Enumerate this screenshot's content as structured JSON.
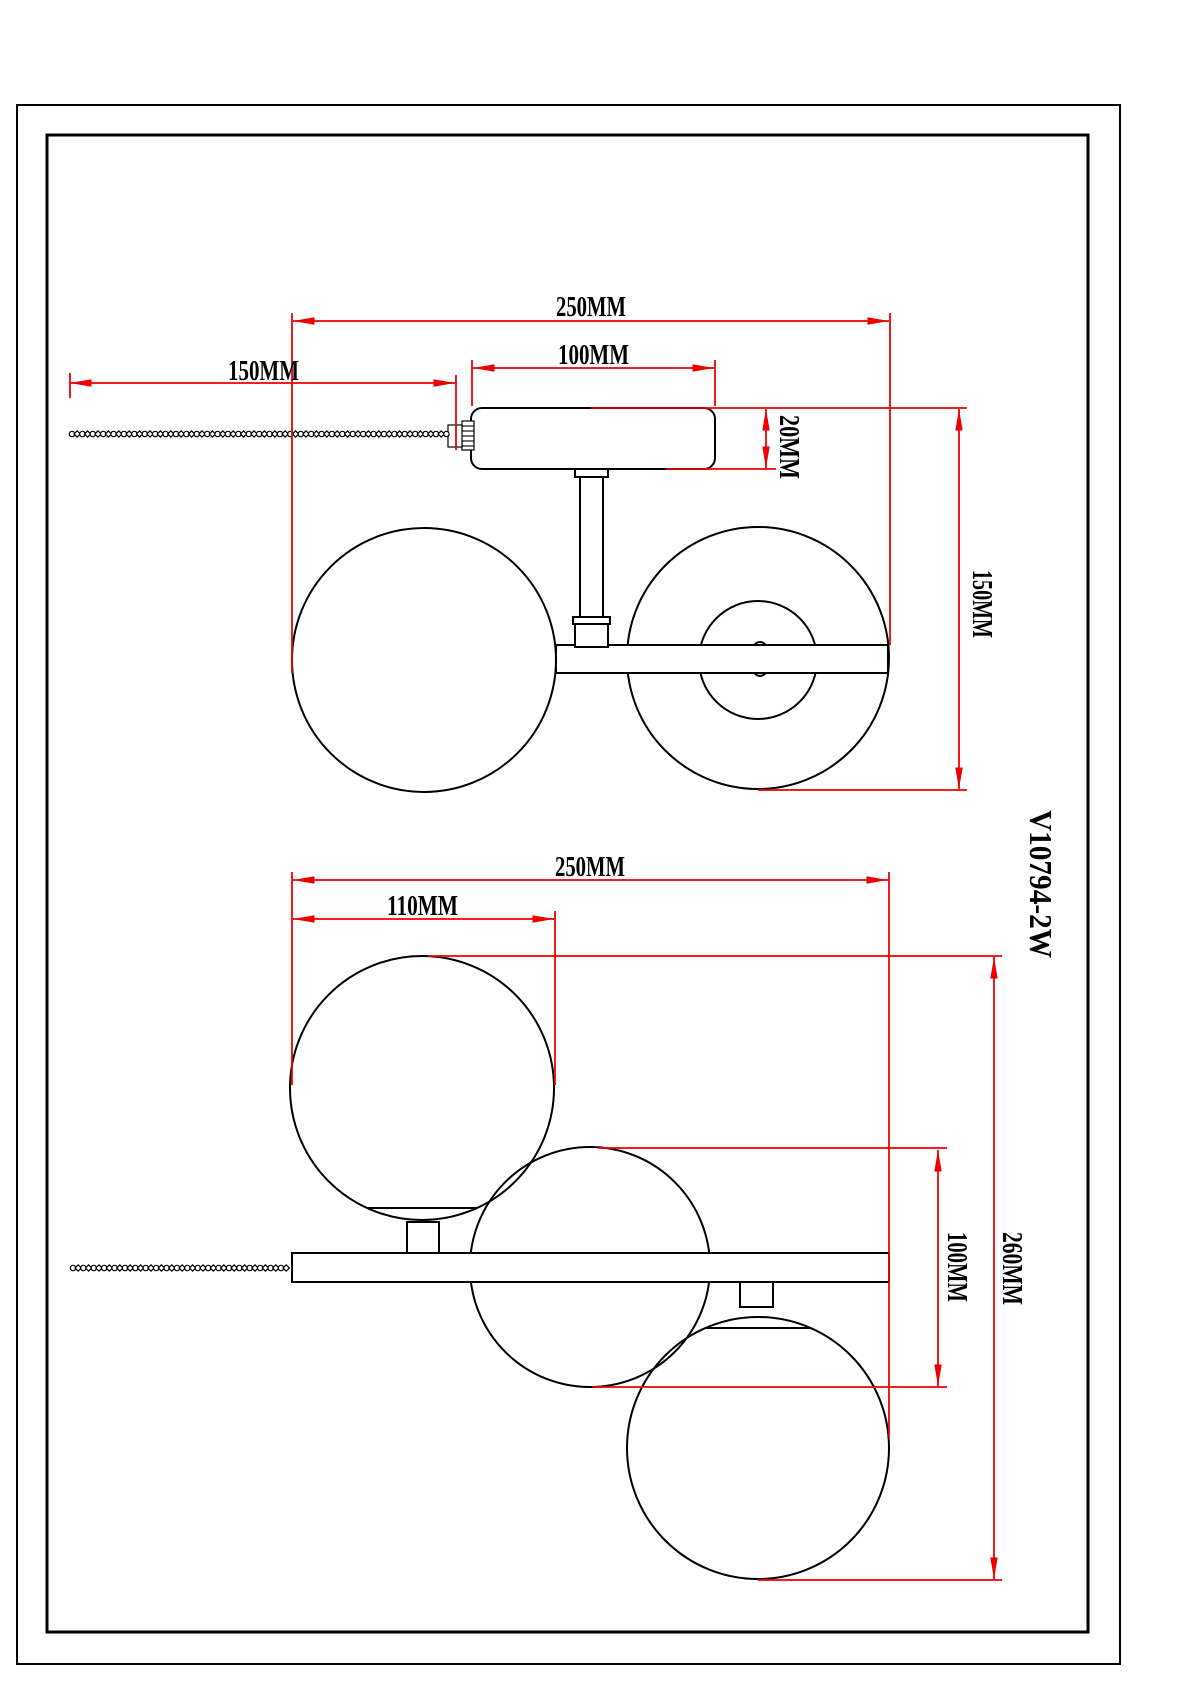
{
  "drawing": {
    "product_code": "V10794-2W",
    "unit": "MM",
    "colors": {
      "dimension_red": "#ee0000",
      "line_black": "#000000",
      "paper_white": "#ffffff"
    },
    "views": {
      "top": {
        "name": "side-view-two-globes",
        "dims": {
          "overall_width": "250MM",
          "chain_length": "150MM",
          "canopy_width": "100MM",
          "canopy_height": "20MM",
          "fixture_height": "150MM"
        }
      },
      "bottom": {
        "name": "front-view-three-globes",
        "dims": {
          "overall_width": "250MM",
          "globe_offset": "110MM",
          "globe_drop": "100MM",
          "fixture_height": "260MM"
        }
      }
    }
  }
}
